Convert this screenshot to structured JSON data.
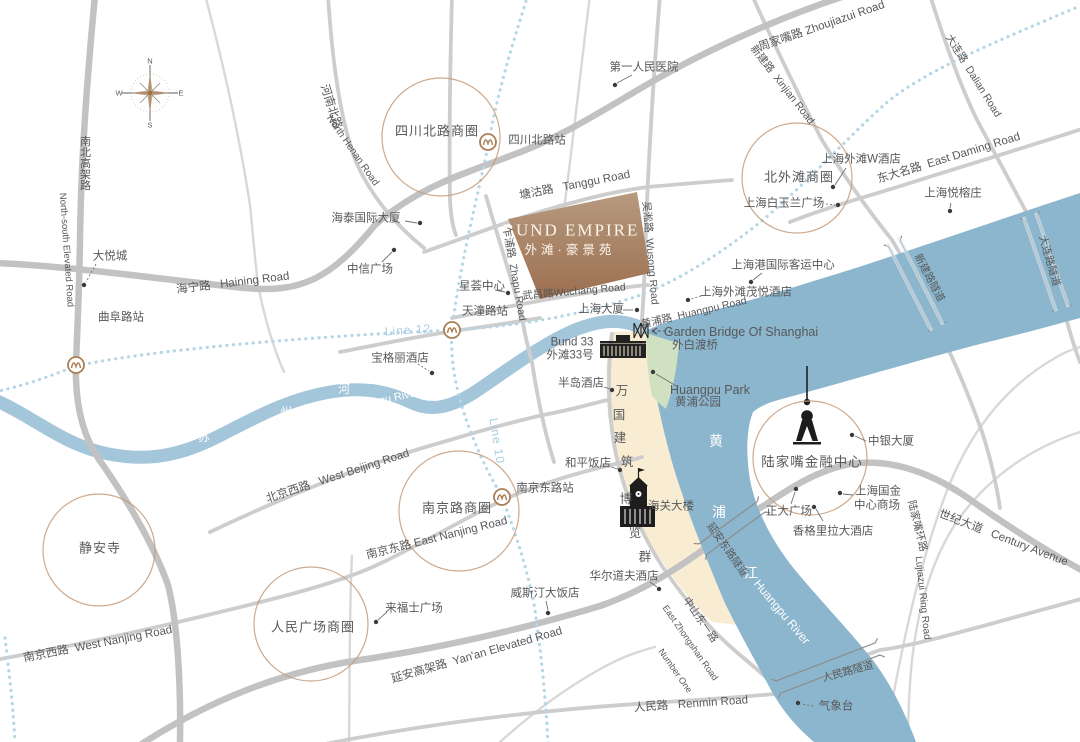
{
  "map": {
    "title": {
      "en": "BUND EMPIRE",
      "zh": "外滩·豪景苑"
    },
    "colors": {
      "river": "#8cb6cd",
      "suzhou": "#a3c6da",
      "bund_strip": "#f8ecd2",
      "park": "#cfe1c0",
      "block_top": "#b79a7f",
      "block_bottom": "#9c6f50",
      "road_thick": "#c2c2c2",
      "road_medium": "#cdcdcd",
      "road_thin": "#d8d8d8",
      "metro_dotted": "#b5d6e6",
      "metro_label": "#a9cee0",
      "district_ring": "#c49a78",
      "text": "#57585a",
      "tunnel": "#8d8d8d"
    },
    "compass": {
      "n": "N",
      "e": "E",
      "s": "S",
      "w": "W"
    },
    "metro_lines": [
      "Line 12",
      "Line 10"
    ],
    "districts": [
      {
        "n": "sichuan-north-road",
        "x": 441,
        "y": 137,
        "r": 59
      },
      {
        "n": "north-bund",
        "x": 797,
        "y": 178,
        "r": 55
      },
      {
        "n": "lujiazui",
        "x": 810,
        "y": 458,
        "r": 57
      },
      {
        "n": "nanjing-road",
        "x": 459,
        "y": 511,
        "r": 60
      },
      {
        "n": "peoples-square",
        "x": 311,
        "y": 624,
        "r": 57
      },
      {
        "n": "jingan-temple",
        "x": 99,
        "y": 550,
        "r": 56
      }
    ],
    "stations": [
      {
        "n": "qufu-road",
        "x": 76,
        "y": 365
      },
      {
        "n": "tiantong-road",
        "x": 452,
        "y": 330
      },
      {
        "n": "sichuan-north-road",
        "x": 488,
        "y": 142
      },
      {
        "n": "east-nanjing-road",
        "x": 502,
        "y": 497
      }
    ],
    "labels": [
      {
        "n": "first-peoples-hospital",
        "t": "第一人民医院",
        "x": 644,
        "y": 68
      },
      {
        "n": "sichuan-north-road-district",
        "t": "四川北路商圈",
        "x": 437,
        "y": 131,
        "s": 13,
        "ls": 1
      },
      {
        "n": "sichuan-north-road-station",
        "t": "四川北路站",
        "x": 537,
        "y": 141
      },
      {
        "n": "north-henan-road-zh",
        "t": "河南北路",
        "x": 330,
        "y": 107,
        "r": 72
      },
      {
        "n": "north-henan-road-en",
        "t": "North Henan Road",
        "x": 352,
        "y": 151,
        "r": 55,
        "s": 10
      },
      {
        "n": "north-south-elevated-zh",
        "t": "南北高架路",
        "x": 84,
        "y": 163,
        "v": 1,
        "s": 11
      },
      {
        "n": "north-south-elevated-en",
        "t": "North-south Elevated Road",
        "x": 66,
        "y": 250,
        "r": 86,
        "s": 9.5
      },
      {
        "n": "haining-road",
        "t": "海宁路   Haining Road",
        "x": 233,
        "y": 284,
        "r": -7
      },
      {
        "n": "joy-city",
        "t": "大悦城",
        "x": 110,
        "y": 257
      },
      {
        "n": "qufu-road-station",
        "t": "曲阜路站",
        "x": 121,
        "y": 318
      },
      {
        "n": "haitai-international-building",
        "t": "海泰国际大厦",
        "x": 366,
        "y": 219
      },
      {
        "n": "citic-plaza",
        "t": "中信广场",
        "x": 370,
        "y": 270
      },
      {
        "n": "xinghui-center",
        "t": "星荟中心",
        "x": 482,
        "y": 287
      },
      {
        "n": "tiantong-road-station",
        "t": "天潼路站",
        "x": 485,
        "y": 312
      },
      {
        "n": "bulgari-hotel",
        "t": "宝格丽酒店",
        "x": 400,
        "y": 359
      },
      {
        "n": "metro-line-12",
        "t": "Line 12",
        "x": 408,
        "y": 330,
        "r": -4,
        "c": "lb",
        "s": 12,
        "ls": 1
      },
      {
        "n": "metro-line-10",
        "t": "Line 10",
        "x": 497,
        "y": 441,
        "r": 81,
        "c": "lb",
        "s": 12,
        "ls": 1
      },
      {
        "n": "tanggu-road",
        "t": "塘沽路   Tanggu Road",
        "x": 575,
        "y": 186,
        "r": -11
      },
      {
        "n": "bund-empire-en",
        "t": "BUND EMPIRE",
        "x": 571,
        "y": 230,
        "s": 17,
        "c": "bw",
        "f": "serif",
        "ls": 2
      },
      {
        "n": "bund-empire-zh",
        "t": "外滩·豪景苑",
        "x": 570,
        "y": 250,
        "s": 12.5,
        "c": "bw",
        "ls": 4
      },
      {
        "n": "zhapu-road",
        "t": "乍浦路  Zhapu Road",
        "x": 514,
        "y": 274,
        "r": 80,
        "s": 10.5
      },
      {
        "n": "wusong-road",
        "t": "吴淞路  Wusong Road",
        "x": 650,
        "y": 253,
        "r": 85,
        "s": 10.5
      },
      {
        "n": "wuchang-road",
        "t": "武昌路Wuchang Road",
        "x": 574,
        "y": 292,
        "r": -5,
        "s": 10.5
      },
      {
        "n": "broadway-mansions",
        "t": "上海大厦",
        "x": 601,
        "y": 310
      },
      {
        "n": "huangpu-road",
        "t": "黄浦路  Huangpu Road",
        "x": 694,
        "y": 313,
        "r": -13,
        "s": 10.5
      },
      {
        "n": "garden-bridge-en",
        "t": "Garden Bridge Of Shanghai",
        "x": 741,
        "y": 332,
        "s": 12.5
      },
      {
        "n": "garden-bridge-zh",
        "t": "外白渡桥",
        "x": 695,
        "y": 346
      },
      {
        "n": "huangpu-park-en",
        "t": "Huangpu Park",
        "x": 710,
        "y": 390,
        "s": 12.5
      },
      {
        "n": "huangpu-park-zh",
        "t": "黄浦公园",
        "x": 698,
        "y": 403
      },
      {
        "n": "port-international-cruise-terminal",
        "t": "上海港国际客运中心",
        "x": 783,
        "y": 266
      },
      {
        "n": "hyatt-on-the-bund",
        "t": "上海外滩茂悦酒店",
        "x": 746,
        "y": 293
      },
      {
        "n": "north-bund-district",
        "t": "北外滩商圈",
        "x": 799,
        "y": 177,
        "s": 13,
        "ls": 1
      },
      {
        "n": "w-hotel",
        "t": "上海外滩W酒店",
        "x": 861,
        "y": 160
      },
      {
        "n": "magnolia-plaza",
        "t": "上海白玉兰广场",
        "x": 784,
        "y": 204
      },
      {
        "n": "zhoujiazui-road",
        "t": "周家嘴路 Zhoujiazui Road",
        "x": 822,
        "y": 27,
        "r": -19
      },
      {
        "n": "xinjian-road",
        "t": "新建路  Xinjian Road",
        "x": 782,
        "y": 85,
        "r": 52,
        "s": 10.5
      },
      {
        "n": "dalian-road",
        "t": "大连路  Dalian Road",
        "x": 973,
        "y": 76,
        "r": 58,
        "s": 10.5
      },
      {
        "n": "east-daming-road",
        "t": "东大名路  East Daming Road",
        "x": 949,
        "y": 159,
        "r": -17
      },
      {
        "n": "banyan-tree-shanghai",
        "t": "上海悦榕庄",
        "x": 953,
        "y": 194
      },
      {
        "n": "xinjian-road-tunnel",
        "t": "新建路隧道",
        "x": 929,
        "y": 278,
        "r": 62,
        "s": 10.5
      },
      {
        "n": "dalian-road-tunnel",
        "t": "大连路隧道",
        "x": 1049,
        "y": 261,
        "r": 74,
        "s": 10.5
      },
      {
        "n": "lujiazui-financial-center",
        "t": "陆家嘴金融中心",
        "x": 812,
        "y": 462,
        "s": 13.5,
        "ls": 1
      },
      {
        "n": "bank-of-china-tower",
        "t": "中银大厦",
        "x": 891,
        "y": 442
      },
      {
        "n": "shanghai-ifc-mall-line1",
        "t": "上海国金",
        "x": 878,
        "y": 492
      },
      {
        "n": "shanghai-ifc-mall-line2",
        "t": "中心商场",
        "x": 877,
        "y": 506
      },
      {
        "n": "super-brand-mall",
        "t": "正大广场",
        "x": 789,
        "y": 512
      },
      {
        "n": "shangri-la-hotel",
        "t": "香格里拉大酒店",
        "x": 833,
        "y": 532
      },
      {
        "n": "lujiazui-ring-road-zh",
        "t": "陆家嘴环路",
        "x": 917,
        "y": 526,
        "r": 76,
        "s": 10.5
      },
      {
        "n": "lujiazui-ring-road-en",
        "t": "Lujiazui Ring Road",
        "x": 922,
        "y": 598,
        "r": 84,
        "s": 10
      },
      {
        "n": "century-avenue",
        "t": "世纪大道   Century Avenue",
        "x": 1003,
        "y": 539,
        "r": 21
      },
      {
        "n": "yanan-east-road-tunnel",
        "t": "延安东路隧道",
        "x": 727,
        "y": 550,
        "r": 55,
        "s": 10.5
      },
      {
        "n": "huangpu-river-char-1",
        "t": "黄",
        "x": 716,
        "y": 441,
        "c": "w",
        "s": 14
      },
      {
        "n": "huangpu-river-char-2",
        "t": "浦",
        "x": 719,
        "y": 512,
        "c": "w",
        "s": 14
      },
      {
        "n": "huangpu-river-char-3",
        "t": "江",
        "x": 751,
        "y": 573,
        "c": "w",
        "s": 14
      },
      {
        "n": "huangpu-river-en",
        "t": "Huangpu River",
        "x": 782,
        "y": 612,
        "r": 50,
        "c": "w",
        "s": 12
      },
      {
        "n": "renmin-road-tunnel",
        "t": "人民路隧道",
        "x": 848,
        "y": 672,
        "r": -15,
        "s": 10.5
      },
      {
        "n": "weather-observatory",
        "t": "气象台",
        "x": 836,
        "y": 707
      },
      {
        "n": "renmin-road",
        "t": "人民路   Renmin Road",
        "x": 691,
        "y": 705,
        "r": -4
      },
      {
        "n": "east-zhongshan-road-zh",
        "t": "中山东一路",
        "x": 700,
        "y": 620,
        "r": 55,
        "s": 10.5
      },
      {
        "n": "east-zhongshan-road-en",
        "t": "East Zhongshan Road",
        "x": 690,
        "y": 643,
        "r": 55,
        "s": 9
      },
      {
        "n": "east-zhongshan-road-number-one",
        "t": "Number One",
        "x": 675,
        "y": 671,
        "r": 55,
        "s": 9
      },
      {
        "n": "yanan-elevated-road",
        "t": "延安高架路  Yan'an Elevated Road",
        "x": 477,
        "y": 656,
        "r": -16
      },
      {
        "n": "raffles-city",
        "t": "来福士广场",
        "x": 414,
        "y": 609
      },
      {
        "n": "westin-hotel",
        "t": "威斯汀大饭店",
        "x": 545,
        "y": 594
      },
      {
        "n": "peoples-square-district",
        "t": "人民广场商圈",
        "x": 313,
        "y": 627,
        "s": 13,
        "ls": 1
      },
      {
        "n": "jingan-temple",
        "t": "静安寺",
        "x": 100,
        "y": 548,
        "s": 13,
        "ls": 1
      },
      {
        "n": "west-beijing-road",
        "t": "北京西路   West Beijing Road",
        "x": 338,
        "y": 477,
        "r": -18
      },
      {
        "n": "west-nanjing-road",
        "t": "南京西路  West Nanjing Road",
        "x": 98,
        "y": 645,
        "r": -11
      },
      {
        "n": "nanjing-road-district",
        "t": "南京路商圈",
        "x": 457,
        "y": 508,
        "s": 13,
        "ls": 1
      },
      {
        "n": "east-nanjing-road-station",
        "t": "南京东路站",
        "x": 545,
        "y": 489
      },
      {
        "n": "east-nanjing-road",
        "t": "南京东路 East Nanjing Road",
        "x": 437,
        "y": 539,
        "r": -14
      },
      {
        "n": "peace-hotel",
        "t": "和平饭店",
        "x": 588,
        "y": 464
      },
      {
        "n": "customs-house",
        "t": "海关大楼",
        "x": 671,
        "y": 507
      },
      {
        "n": "waldorf-astoria",
        "t": "华尔道夫酒店",
        "x": 624,
        "y": 577
      },
      {
        "n": "bund-33-en",
        "t": "Bund 33",
        "x": 572,
        "y": 343
      },
      {
        "n": "bund-33-zh",
        "t": "外滩33号",
        "x": 570,
        "y": 356
      },
      {
        "n": "peninsula-hotel",
        "t": "半岛酒店",
        "x": 581,
        "y": 384
      },
      {
        "n": "bund-strip-char-1",
        "t": "万",
        "x": 622,
        "y": 391,
        "s": 12.5
      },
      {
        "n": "bund-strip-char-2",
        "t": "国",
        "x": 619,
        "y": 415,
        "s": 12.5
      },
      {
        "n": "bund-strip-char-3",
        "t": "建",
        "x": 620,
        "y": 438,
        "s": 12.5
      },
      {
        "n": "bund-strip-char-4",
        "t": "筑",
        "x": 627,
        "y": 462,
        "s": 12.5
      },
      {
        "n": "bund-strip-char-5",
        "t": "博",
        "x": 626,
        "y": 499,
        "s": 12.5
      },
      {
        "n": "bund-strip-char-6",
        "t": "览",
        "x": 635,
        "y": 533,
        "s": 12.5
      },
      {
        "n": "bund-strip-char-7",
        "t": "群",
        "x": 645,
        "y": 557,
        "s": 12.5
      },
      {
        "n": "suzhou-river-char-1",
        "t": "苏",
        "x": 204,
        "y": 437,
        "c": "w",
        "s": 12
      },
      {
        "n": "suzhou-river-char-2",
        "t": "州",
        "x": 286,
        "y": 412,
        "c": "w",
        "s": 12
      },
      {
        "n": "suzhou-river-char-3",
        "t": "河",
        "x": 344,
        "y": 389,
        "c": "w",
        "s": 12
      },
      {
        "n": "suzhou-river-en",
        "t": "Suzhou River",
        "x": 387,
        "y": 400,
        "r": -12,
        "c": "w",
        "s": 11
      },
      {
        "n": "compass-n",
        "t": "N",
        "x": 150,
        "y": 61,
        "s": 7.5
      },
      {
        "n": "compass-e",
        "t": "E",
        "x": 181,
        "y": 93,
        "s": 7.5
      },
      {
        "n": "compass-s",
        "t": "S",
        "x": 150,
        "y": 125,
        "s": 7.5
      },
      {
        "n": "compass-w",
        "t": "W",
        "x": 119,
        "y": 93,
        "s": 7.5
      }
    ],
    "dots": [
      {
        "x": 615,
        "y": 85
      },
      {
        "x": 420,
        "y": 223
      },
      {
        "x": 394,
        "y": 250
      },
      {
        "x": 508,
        "y": 293
      },
      {
        "x": 84,
        "y": 285
      },
      {
        "x": 432,
        "y": 373
      },
      {
        "x": 637,
        "y": 310
      },
      {
        "x": 751,
        "y": 282
      },
      {
        "x": 688,
        "y": 300
      },
      {
        "x": 833,
        "y": 187
      },
      {
        "x": 838,
        "y": 205
      },
      {
        "x": 950,
        "y": 211
      },
      {
        "x": 653,
        "y": 372
      },
      {
        "x": 852,
        "y": 435
      },
      {
        "x": 840,
        "y": 493
      },
      {
        "x": 796,
        "y": 489
      },
      {
        "x": 814,
        "y": 507
      },
      {
        "x": 798,
        "y": 703
      },
      {
        "x": 376,
        "y": 622
      },
      {
        "x": 548,
        "y": 613
      },
      {
        "x": 620,
        "y": 470
      },
      {
        "x": 659,
        "y": 589
      },
      {
        "x": 612,
        "y": 390
      }
    ],
    "leaders": [
      {
        "x1": 632,
        "y1": 75,
        "x2": 617,
        "y2": 83
      },
      {
        "x1": 405,
        "y1": 221,
        "x2": 417,
        "y2": 223
      },
      {
        "x1": 382,
        "y1": 262,
        "x2": 392,
        "y2": 252
      },
      {
        "x1": 495,
        "y1": 290,
        "x2": 505,
        "y2": 292
      },
      {
        "x1": 96,
        "y1": 264,
        "x2": 86,
        "y2": 282,
        "d": 1
      },
      {
        "x1": 418,
        "y1": 364,
        "x2": 429,
        "y2": 371,
        "d": 1
      },
      {
        "x1": 623,
        "y1": 310,
        "x2": 633,
        "y2": 310
      },
      {
        "x1": 762,
        "y1": 273,
        "x2": 753,
        "y2": 280
      },
      {
        "x1": 701,
        "y1": 296,
        "x2": 691,
        "y2": 299,
        "d": 1
      },
      {
        "x1": 846,
        "y1": 168,
        "x2": 835,
        "y2": 185
      },
      {
        "x1": 826,
        "y1": 204,
        "x2": 835,
        "y2": 205,
        "d": 1
      },
      {
        "x1": 951,
        "y1": 203,
        "x2": 950,
        "y2": 208
      },
      {
        "x1": 678,
        "y1": 387,
        "x2": 656,
        "y2": 374
      },
      {
        "x1": 866,
        "y1": 441,
        "x2": 855,
        "y2": 436
      },
      {
        "x1": 853,
        "y1": 495,
        "x2": 843,
        "y2": 494
      },
      {
        "x1": 791,
        "y1": 504,
        "x2": 795,
        "y2": 492
      },
      {
        "x1": 823,
        "y1": 521,
        "x2": 816,
        "y2": 509
      },
      {
        "x1": 813,
        "y1": 706,
        "x2": 801,
        "y2": 704,
        "d": 1
      },
      {
        "x1": 387,
        "y1": 612,
        "x2": 378,
        "y2": 620
      },
      {
        "x1": 546,
        "y1": 601,
        "x2": 548,
        "y2": 610
      },
      {
        "x1": 611,
        "y1": 467,
        "x2": 618,
        "y2": 469
      },
      {
        "x1": 650,
        "y1": 582,
        "x2": 657,
        "y2": 587
      },
      {
        "x1": 604,
        "y1": 387,
        "x2": 610,
        "y2": 389
      }
    ]
  }
}
